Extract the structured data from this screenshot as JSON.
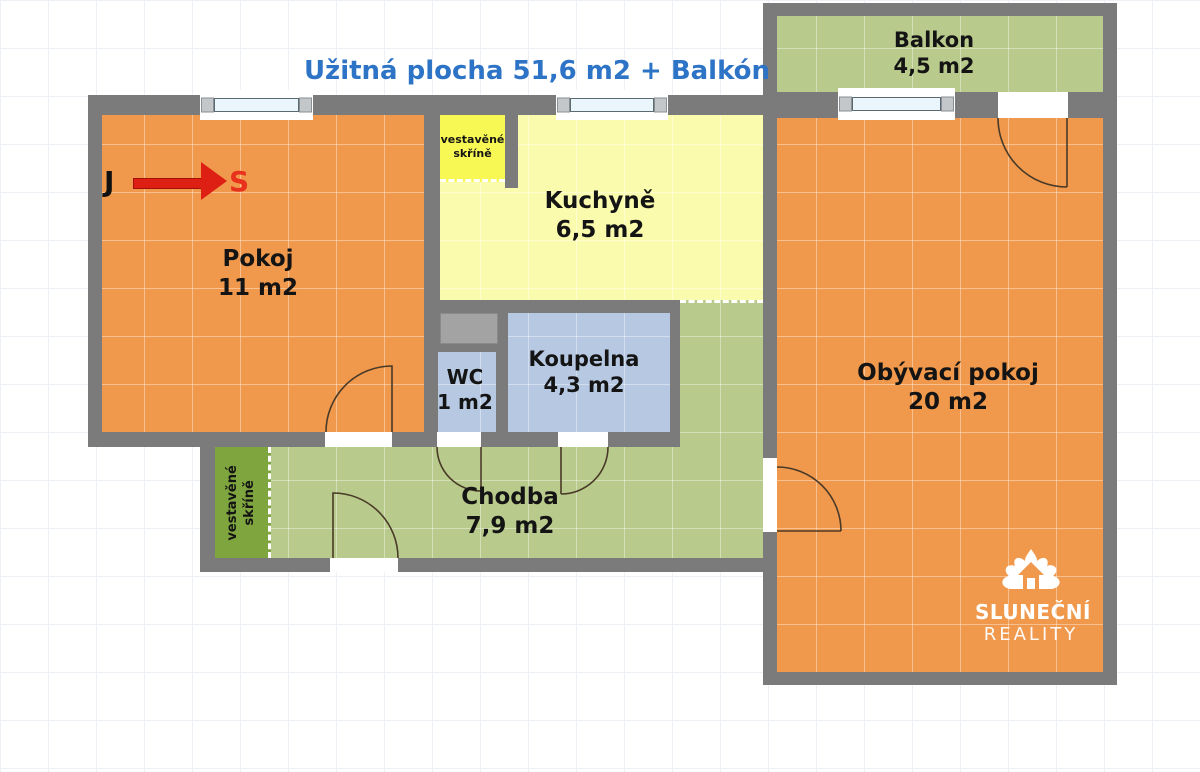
{
  "title": "Užitná plocha 51,6 m2 + Balkón",
  "compass": {
    "from": "J",
    "to": "S"
  },
  "rooms": {
    "pokoj": {
      "name": "Pokoj",
      "area": "11 m2",
      "color": "#F0994C"
    },
    "kuchyne": {
      "name": "Kuchyně",
      "area": "6,5 m2",
      "color": "#FBFBAE"
    },
    "balkon": {
      "name": "Balkon",
      "area": "4,5 m2",
      "color": "#B9CB8C"
    },
    "obyvaci_pokoj": {
      "name": "Obývací pokoj",
      "area": "20 m2",
      "color": "#F0994C"
    },
    "wc": {
      "name": "WC",
      "area": "1 m2",
      "color": "#B7C9E2"
    },
    "koupelna": {
      "name": "Koupelna",
      "area": "4,3 m2",
      "color": "#B7C9E2"
    },
    "chodba": {
      "name": "Chodba",
      "area": "7,9 m2",
      "color": "#B9CB8C"
    }
  },
  "wardrobes": {
    "kitchen": {
      "line1": "vestavěné",
      "line2": "skříně"
    },
    "hall": {
      "line1": "vestavěné",
      "line2": "skříně"
    }
  },
  "logo": {
    "line1": "SLUNEČNÍ",
    "line2": "REALITY"
  },
  "icons": {
    "compass_arrow": "arrow-right",
    "logo_mark": "sun-house"
  },
  "colors": {
    "wall": "#7B7B7B",
    "room_orange": "#F0994C",
    "kitchen_yellow": "#FBFBAE",
    "wardrobe_yellow": "#F8F855",
    "green": "#B9CB8C",
    "wardrobe_green": "#7FA53E",
    "bath_blue": "#B7C9E2",
    "shaft_gray": "#A3A3A3",
    "title_blue": "#2E74C6",
    "arrow_red": "#DE1F14",
    "door_line": "#4a3a28"
  }
}
